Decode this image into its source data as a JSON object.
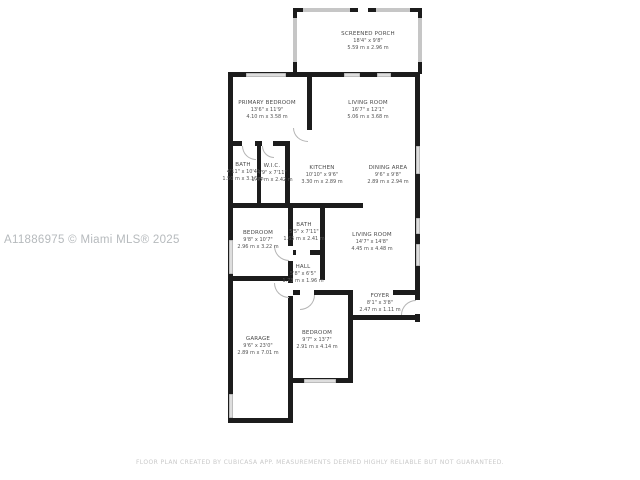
{
  "watermark": "A11886975 © Miami MLS® 2025",
  "disclaimer": "FLOOR PLAN CREATED BY CUBICASA APP. MEASUREMENTS DEEMED HIGHLY RELIABLE BUT NOT GUARANTEED.",
  "colors": {
    "wall": "#1c1c1c",
    "porch_wall": "#c6c6c6",
    "window": "#dedede",
    "label_text": "#4a4a4a",
    "watermark_text": "#b6babd",
    "disclaimer_text": "#c9c9c9",
    "background": "#ffffff"
  },
  "rooms": [
    {
      "name": "SCREENED PORCH",
      "dims_ft": "18'4\" x 9'8\"",
      "dims_m": "5.59 m x 2.96 m"
    },
    {
      "name": "PRIMARY BEDROOM",
      "dims_ft": "13'6\" x 11'9\"",
      "dims_m": "4.10 m x 3.58 m"
    },
    {
      "name": "LIVING ROOM",
      "dims_ft": "16'7\" x 12'1\"",
      "dims_m": "5.06 m x 3.68 m"
    },
    {
      "name": "BATH",
      "dims_ft": "4'11\" x 10'4\"",
      "dims_m": "1.50 m x 3.16 m"
    },
    {
      "name": "W.I.C.",
      "dims_ft": "4'9\" x 7'11\"",
      "dims_m": "1.45 m x 2.42 m"
    },
    {
      "name": "KITCHEN",
      "dims_ft": "10'10\" x 9'6\"",
      "dims_m": "3.30 m x 2.89 m"
    },
    {
      "name": "DINING AREA",
      "dims_ft": "9'6\" x 9'8\"",
      "dims_m": "2.89 m x 2.94 m"
    },
    {
      "name": "BEDROOM",
      "dims_ft": "9'8\" x 10'7\"",
      "dims_m": "2.96 m x 3.22 m"
    },
    {
      "name": "BATH",
      "dims_ft": "5'5\" x 7'11\"",
      "dims_m": "1.65 m x 2.41 m"
    },
    {
      "name": "LIVING ROOM",
      "dims_ft": "14'7\" x 14'8\"",
      "dims_m": "4.45 m x 4.48 m"
    },
    {
      "name": "HALL",
      "dims_ft": "5'8\" x 6'5\"",
      "dims_m": "1.73 m x 1.96 m"
    },
    {
      "name": "FOYER",
      "dims_ft": "8'1\" x 3'8\"",
      "dims_m": "2.47 m x 1.11 m"
    },
    {
      "name": "GARAGE",
      "dims_ft": "9'6\" x 23'0\"",
      "dims_m": "2.89 m x 7.01 m"
    },
    {
      "name": "BEDROOM",
      "dims_ft": "9'7\" x 13'7\"",
      "dims_m": "2.91 m x 4.14 m"
    }
  ]
}
